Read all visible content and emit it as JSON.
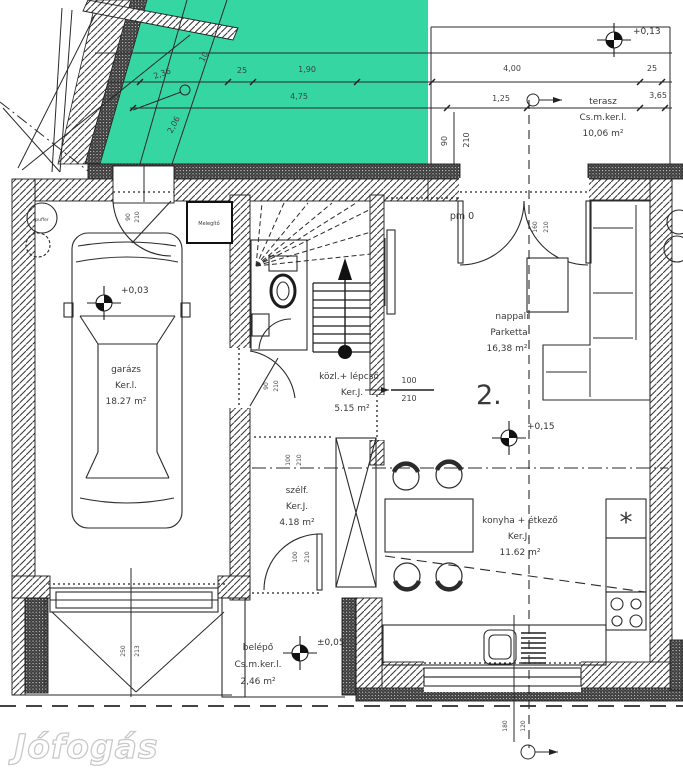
{
  "watermark": {
    "text": "Jófogás"
  },
  "unit_label": "2.",
  "pm_label": "pm 0",
  "colors": {
    "green": "#35d6a2",
    "ink": "#222222",
    "wall_dark": "#3d3d3d",
    "watermark": "#c9c9c9"
  },
  "rooms": {
    "garazs": {
      "name": "garázs",
      "finish": "Ker.l.",
      "area": "18.27 m²"
    },
    "kozl": {
      "name": "közl.+ lépcső",
      "finish": "Ker.J.",
      "area": "5.15 m²"
    },
    "nappali": {
      "name": "nappali",
      "finish": "Parketta",
      "area": "16,38 m²"
    },
    "terasz": {
      "name": "terasz",
      "finish": "Cs.m.ker.l.",
      "area": "10,06 m²"
    },
    "szelfogo": {
      "name": "szélf.",
      "finish": "Ker.J.",
      "area": "4.18 m²"
    },
    "konyha": {
      "name": "konyha + étkező",
      "finish": "Ker.J.",
      "area": "11.62 m²"
    },
    "belepo": {
      "name": "belépő",
      "finish": "Cs.m.ker.l.",
      "area": "2,46 m²"
    }
  },
  "levels": {
    "terasz": "+0,13",
    "garazs": "+0,03",
    "nappali": "+0,15",
    "belepo": "±0,05"
  },
  "equipment": {
    "heater": "Melegítő",
    "buffer": "puffer",
    "fridge_symbol": "*"
  },
  "dims": {
    "w2_36": "2,36",
    "w0_10": "10",
    "w0_25": "25",
    "w1_90": "1,90",
    "w4_00": "4,00",
    "w4_75": "4,75",
    "w1_25": "1,25",
    "w3_65": "3,65",
    "w2_06": "2,06",
    "d90": "90",
    "d210": "210",
    "d100": "100",
    "d160": "160",
    "d180": "180",
    "d120": "120",
    "d250": "250",
    "d213": "213"
  }
}
